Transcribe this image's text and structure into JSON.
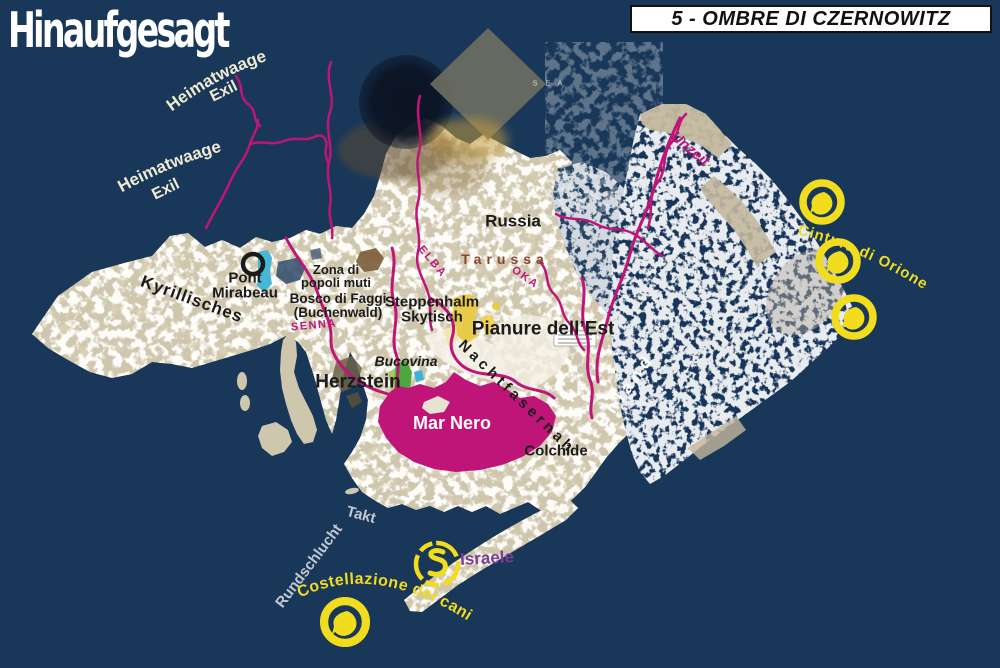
{
  "header": {
    "logo": "Hinaufgesagt",
    "title": "5 - OMBRE DI CZERNOWITZ"
  },
  "colors": {
    "sea_navy": "#193859",
    "land_beige": "#cfc6ae",
    "magenta": "#bf1478",
    "yellow": "#f2dc1e",
    "cream": "#f0ead2",
    "gray_label": "#c2c8d1",
    "purple": "#7b3d97",
    "rust": "#8a4630",
    "black": "#1b1b1b",
    "white": "#ffffff"
  },
  "labels": {
    "heimatwaage": {
      "line1": "Heimatwaage",
      "line2": "Exil"
    },
    "kyrillisches": "Kyrillisches",
    "pont_mirabeau": {
      "line1": "Pont",
      "line2": "Mirabeau"
    },
    "zona": {
      "line1": "Zona di",
      "line2": "popoli muti"
    },
    "bosco": {
      "line1": "Bosco di Faggi",
      "line2": "(Buchenwald)"
    },
    "senna": "SENNA",
    "steppenhalm": {
      "line1": "Steppenhalm",
      "line2": "Skytisch"
    },
    "pianure": "Pianure dell’Est",
    "russia": "Russia",
    "tarussa": "Tarussa",
    "elba": "ELBA",
    "oka": "OKA",
    "bucovina": "Bucovina",
    "herzstein": "Herzstein",
    "mar_nero": "Mar Nero",
    "nachtfasernah": "Nachtfasernah",
    "unland": "Unland",
    "colchide": "Colchide",
    "unzeit": "Unzeit",
    "cintura_orione": "Cintura di Orione",
    "takt": "Takt",
    "rundschlucht": "Rundschlucht",
    "costellazione": "Costellazione dei cani",
    "israele": "Israele",
    "base_map": {
      "sea": "S E A",
      "aza": "A Z A"
    }
  }
}
